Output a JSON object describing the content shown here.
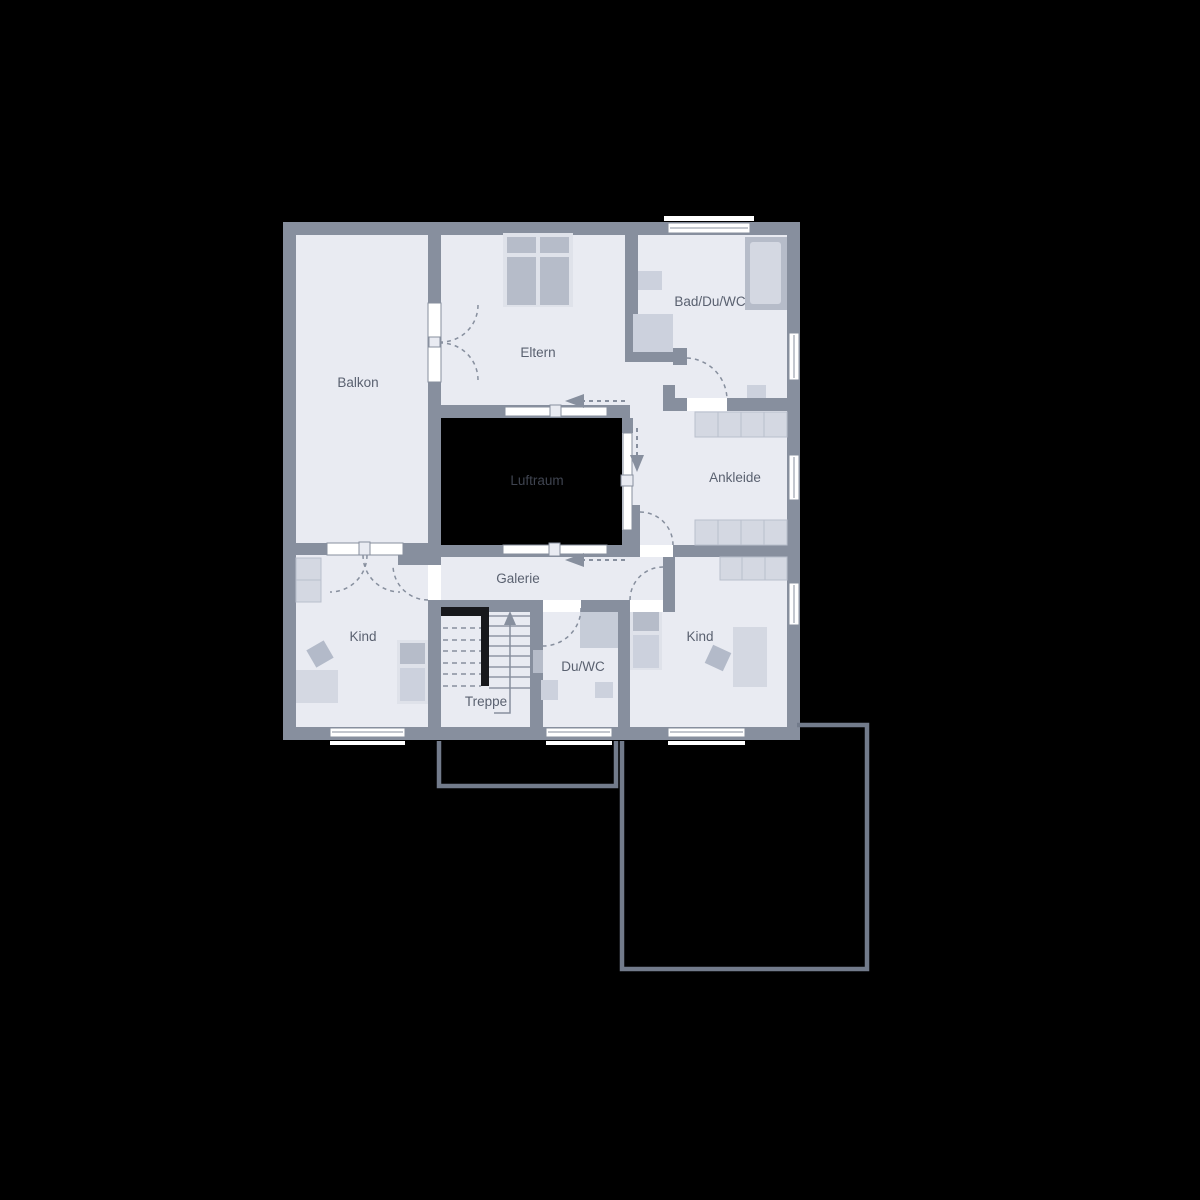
{
  "plan": {
    "rooms": {
      "balkon": {
        "label": "Balkon"
      },
      "eltern": {
        "label": "Eltern"
      },
      "bad": {
        "label": "Bad/Du/WC"
      },
      "ankleide": {
        "label": "Ankleide"
      },
      "luftraum": {
        "label": "Luftraum"
      },
      "galerie": {
        "label": "Galerie"
      },
      "kind_left": {
        "label": "Kind"
      },
      "treppe": {
        "label": "Treppe"
      },
      "duwc": {
        "label": "Du/WC"
      },
      "kind_right": {
        "label": "Kind"
      }
    },
    "palette": {
      "background": "#000000",
      "wall": "#878f9e",
      "floor": "#e9ebf2",
      "void": "#000000",
      "furniture_light": "#d4d8e2",
      "furniture_mid": "#ccd1dd",
      "furniture_dark": "#b6bcc9",
      "stair_accent": "#17181c",
      "outline": "#727b8b",
      "door_window": "#ffffff",
      "label_text": "#5a6170",
      "void_label_text": "#3f4450"
    }
  }
}
